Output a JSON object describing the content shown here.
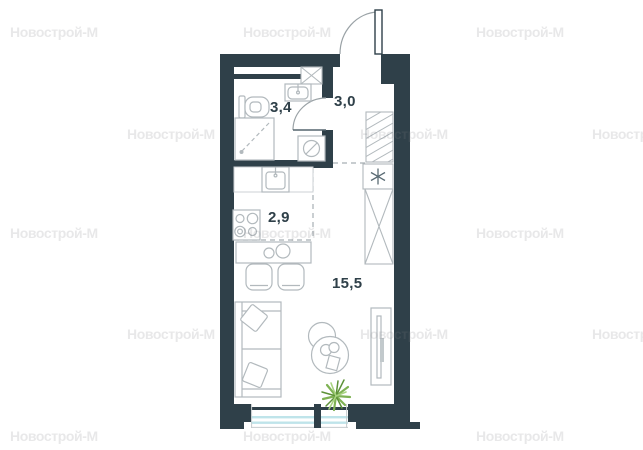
{
  "plan": {
    "title": "studio-apartment-floor-plan",
    "rooms": [
      {
        "id": "bathroom",
        "area_label": "3,4"
      },
      {
        "id": "hallway",
        "area_label": "3,0"
      },
      {
        "id": "kitchen",
        "area_label": "2,9"
      },
      {
        "id": "living-room",
        "area_label": "15,5"
      }
    ],
    "fixtures": [
      "entrance-door",
      "bathroom-door",
      "ventilation-shaft",
      "toilet",
      "washbasin",
      "shower",
      "washing-machine",
      "kitchen-counter",
      "kitchen-sink",
      "stove",
      "dining-table",
      "chair",
      "chair",
      "coat-closet",
      "asterisk-unit",
      "wardrobe",
      "sofa",
      "pillow",
      "pillow",
      "coffee-tables",
      "tv-stand",
      "plant",
      "window"
    ]
  },
  "watermark": {
    "text": "Новострой-М",
    "color": "rgba(125,129,132,0.18)",
    "positions": [
      [
        10,
        24
      ],
      [
        243,
        24
      ],
      [
        476,
        24
      ],
      [
        127,
        126
      ],
      [
        360,
        126
      ],
      [
        592,
        126
      ],
      [
        10,
        225
      ],
      [
        243,
        225
      ],
      [
        476,
        225
      ],
      [
        127,
        326
      ],
      [
        360,
        326
      ],
      [
        592,
        326
      ],
      [
        10,
        428
      ],
      [
        243,
        428
      ],
      [
        476,
        428
      ]
    ]
  },
  "colors": {
    "wall": "#2f4049",
    "furniture_line": "#b2b9bd",
    "dashed_line": "#a7afb3",
    "window_glass": "#bfe4ea",
    "plant_green": "#7fb254",
    "label_text": "#2f4049",
    "background": "#ffffff"
  }
}
